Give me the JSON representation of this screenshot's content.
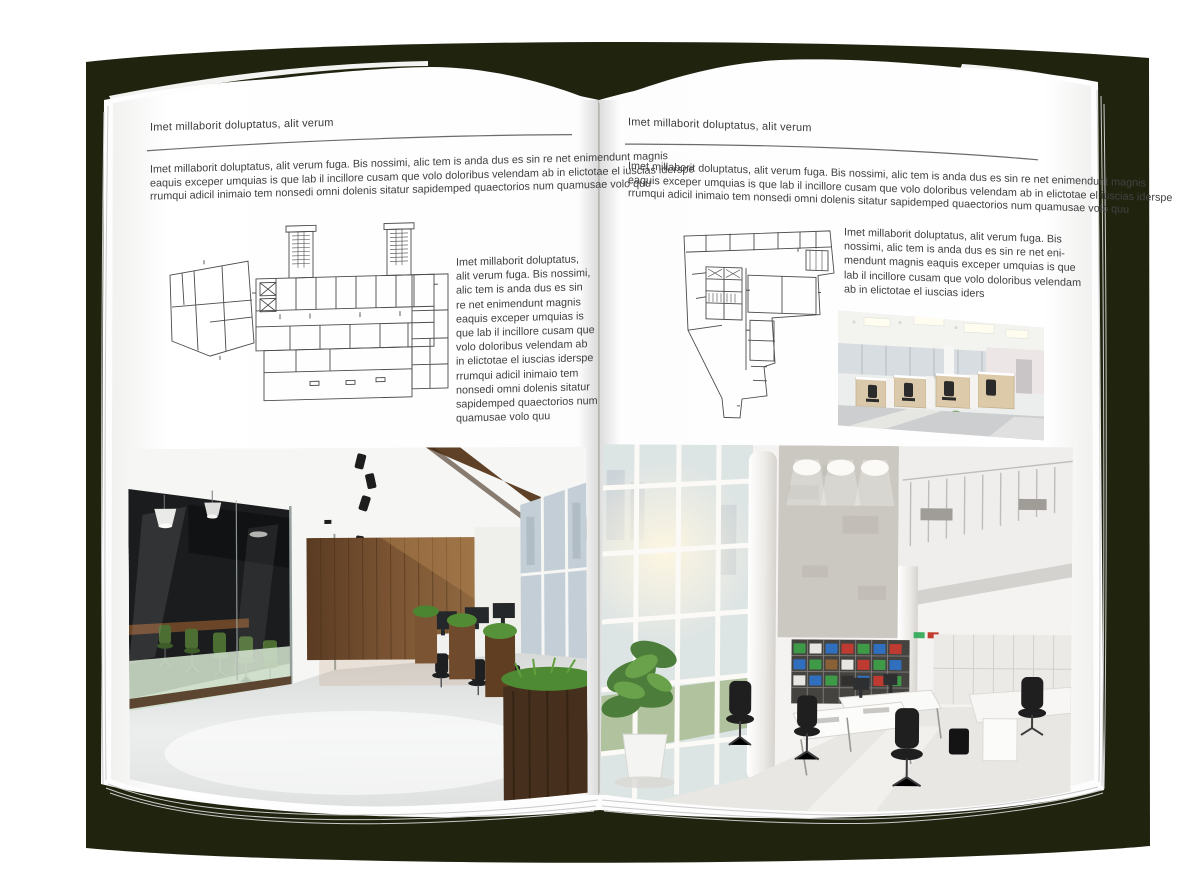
{
  "document": {
    "type": "magazine-spread-mockup",
    "colors": {
      "backdrop": "#20240f",
      "page": "#ffffff",
      "body_text": "#414141",
      "rule": "#6b6b6b",
      "plan_line": "#4b4b4b"
    },
    "left_page": {
      "kicker": "Imet millaborit doluptatus, alit verum",
      "intro_lines": [
        "Imet millaborit doluptatus, alit verum fuga. Bis nossimi, alic tem is anda dus es sin re net enimendunt magnis",
        "eaquis exceper umquias is que lab il incillore cusam que volo doloribus velendam ab in elictotae el iuscias iderspe",
        "rrumqui adicil inimaio tem nonsedi omni dolenis sitatur sapidemped quaectorios num quamusae volo quu"
      ],
      "side_lines": [
        "Imet millaborit doluptatus,",
        "alit verum fuga. Bis nossimi,",
        "alic tem is anda dus es sin",
        "re net enimendunt magnis",
        "eaquis exceper umquias is",
        "que lab il incillore cusam que",
        "volo doloribus velendam ab",
        "in elictotae el iuscias iderspe",
        "rrumqui adicil inimaio tem",
        "nonsedi omni dolenis sitatur",
        "sapidemped quaectorios num",
        "quamusae volo quu"
      ],
      "floorplan_name": "building-floor-plan-a",
      "photo_name": "dark-wood-office-interior-photo"
    },
    "right_page": {
      "kicker": "Imet millaborit doluptatus, alit verum",
      "intro_lines": [
        "Imet millaborit doluptatus, alit verum fuga. Bis nossimi, alic tem is anda dus es sin re net enimendunt magnis",
        "eaquis exceper umquias is que lab il incillore cusam que volo doloribus velendam ab in elictotae el iuscias iderspe",
        "rrumqui adicil inimaio tem nonsedi omni dolenis sitatur sapidemped quaectorios num quamusae volo quu"
      ],
      "side_lines": [
        "Imet millaborit doluptatus, alit verum fuga. Bis",
        "nossimi, alic tem is anda dus es sin re net eni-",
        "mendunt magnis eaquis exceper umquias is que",
        "lab il incillore cusam que volo doloribus velendam",
        "ab in elictotae el iuscias iders"
      ],
      "floorplan_name": "building-floor-plan-b",
      "photo_small_name": "open-space-workstations-photo",
      "photo_name": "white-loft-office-photo"
    }
  }
}
